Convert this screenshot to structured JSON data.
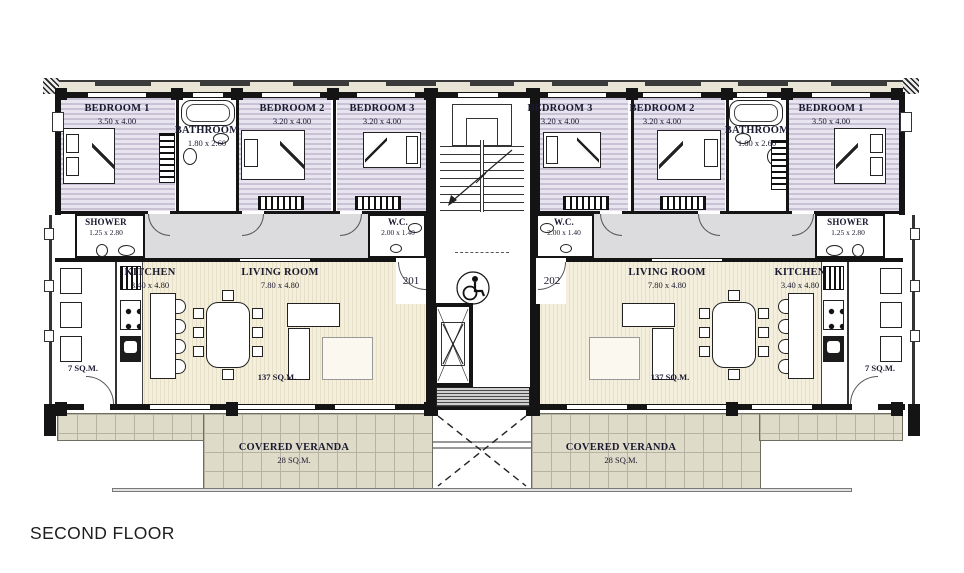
{
  "floor_title": "SECOND FLOOR",
  "units": {
    "left": {
      "door_number": "201"
    },
    "right": {
      "door_number": "202"
    }
  },
  "rooms": {
    "left": {
      "bedroom1": {
        "name": "BEDROOM 1",
        "dims": "3.50 x 4.00"
      },
      "bathroom": {
        "name": "BATHROOM",
        "dims": "1.80 x 2.60"
      },
      "bedroom2": {
        "name": "BEDROOM 2",
        "dims": "3.20 x 4.00"
      },
      "bedroom3": {
        "name": "BEDROOM 3",
        "dims": "3.20 x 4.00"
      },
      "shower": {
        "name": "SHOWER",
        "dims": "1.25 x 2.80"
      },
      "wc": {
        "name": "W.C.",
        "dims": "2.00 x 1.40"
      },
      "kitchen": {
        "name": "KITCHEN",
        "dims": "3.40 x 4.80"
      },
      "living_room": {
        "name": "LIVING ROOM",
        "dims": "7.80 x 4.80"
      },
      "unit_area": "137 SQ.M.",
      "balcony_area": "7 SQ.M.",
      "veranda": {
        "name": "COVERED VERANDA",
        "area": "28 SQ.M."
      }
    },
    "right": {
      "bedroom1": {
        "name": "BEDROOM 1",
        "dims": "3.50 x 4.00"
      },
      "bathroom": {
        "name": "BATHROOM",
        "dims": "1.80 x 2.60"
      },
      "bedroom2": {
        "name": "BEDROOM 2",
        "dims": "3.20 x 4.00"
      },
      "bedroom3": {
        "name": "BEDROOM 3",
        "dims": "3.20 x 4.00"
      },
      "shower": {
        "name": "SHOWER",
        "dims": "1.25 x 2.80"
      },
      "wc": {
        "name": "W.C.",
        "dims": "2.00 x 1.40"
      },
      "kitchen": {
        "name": "KITCHEN",
        "dims": "3.40 x 4.80"
      },
      "living_room": {
        "name": "LIVING ROOM",
        "dims": "7.80 x 4.80"
      },
      "unit_area": "137 SQ.M.",
      "balcony_area": "7 SQ.M.",
      "veranda": {
        "name": "COVERED VERANDA",
        "area": "28 SQ.M."
      }
    }
  },
  "colors": {
    "bedroom_fill": "#c9c2d4",
    "living_fill": "#f0ead3",
    "veranda_fill": "#dfdbc9",
    "corridor_fill": "#dcdbdd",
    "wall": "#141414"
  }
}
